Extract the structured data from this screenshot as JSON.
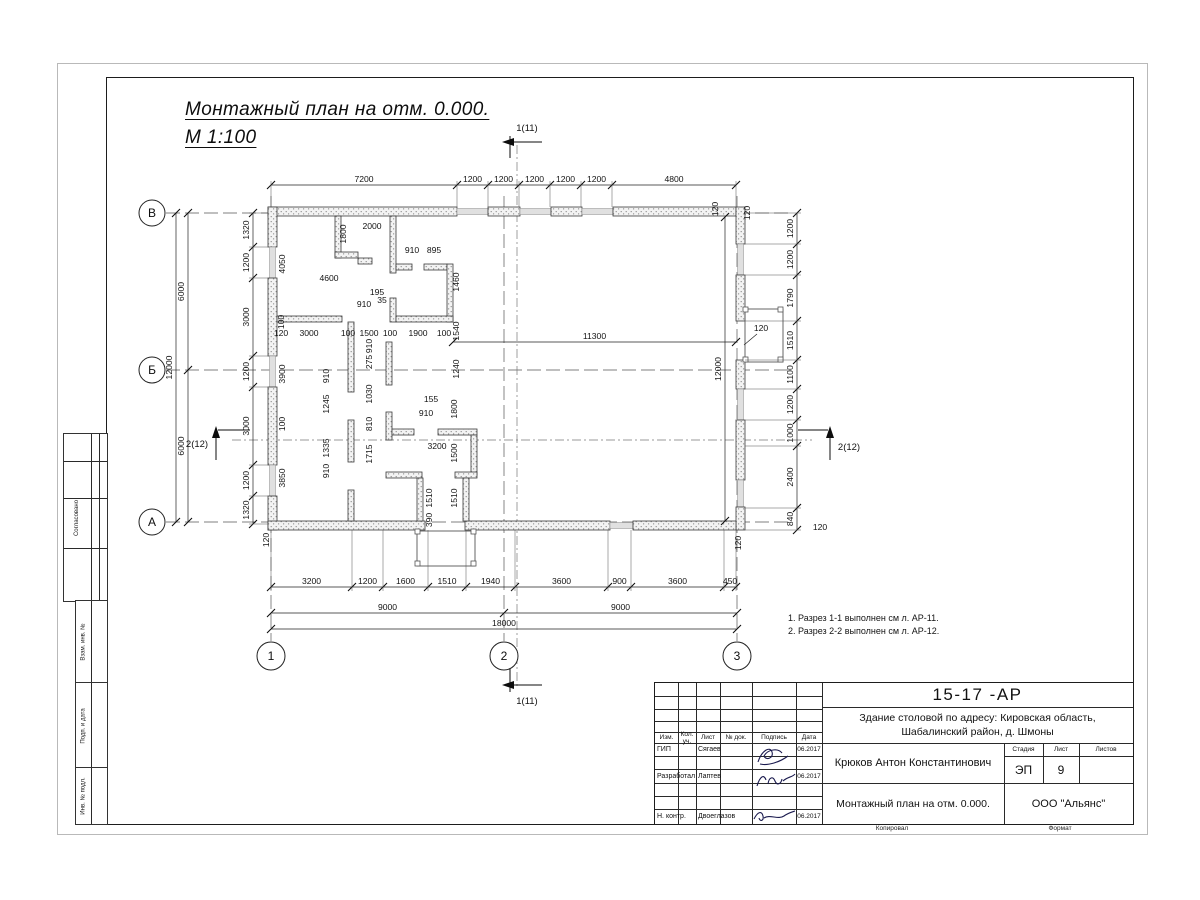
{
  "sheet": {
    "title_line1": "Монтажный план на отм. 0.000.",
    "title_line2": "М 1:100",
    "notes": [
      "1. Разрез 1-1 выполнен см л. АР-11.",
      "2. Разрез 2-2 выполнен см л. АР-12."
    ],
    "footer": {
      "copied": "Копировал",
      "format": "Формат"
    }
  },
  "side_panel": {
    "agree": "Согласовано",
    "vzam": "Взам. инв. №",
    "podp": "Подп. и дата",
    "inv": "Инв. № подл."
  },
  "title_block": {
    "doc_number": "15-17 -АР",
    "project_line1": "Здание столовой по адресу: Кировская область,",
    "project_line2": "Шабалинский район, д. Шмоны",
    "cols": {
      "izm": "Изм.",
      "kol": "Кол. уч.",
      "list": "Лист",
      "ndok": "№ док.",
      "podpis": "Подпись",
      "data": "Дата"
    },
    "rows": [
      {
        "role": "ГИП",
        "name": "Сягаев",
        "date": "06.2017"
      },
      {
        "role": "Разработал",
        "name": "Лаптев",
        "date": "06.2017"
      },
      {
        "role": "Н. контр.",
        "name": "Двоеглазов",
        "date": "06.2017"
      }
    ],
    "author": "Крюков Антон Константинович",
    "stage_label": "Стадия",
    "sheet_label": "Лист",
    "sheets_label": "Листов",
    "stage": "ЭП",
    "sheet_no": "9",
    "drawing_name": "Монтажный план на отм. 0.000.",
    "company": "ООО \"Альянс\""
  },
  "plan": {
    "axes": [
      {
        "label": "В",
        "x": 152,
        "y": 213,
        "r": 13
      },
      {
        "label": "Б",
        "x": 152,
        "y": 370,
        "r": 13
      },
      {
        "label": "А",
        "x": 152,
        "y": 522,
        "r": 13
      },
      {
        "label": "1",
        "x": 271,
        "y": 656,
        "r": 14
      },
      {
        "label": "2",
        "x": 504,
        "y": 656,
        "r": 14
      },
      {
        "label": "3",
        "x": 737,
        "y": 656,
        "r": 14
      }
    ],
    "chains": [
      {
        "dir": "h",
        "pos": 185,
        "ticks": [
          271,
          457,
          488,
          519,
          550,
          581,
          612,
          736
        ],
        "labels": [
          "7200",
          "1200",
          "1200",
          "1200",
          "1200",
          "1200",
          "4800"
        ],
        "ext": [
          181,
          207
        ]
      },
      {
        "dir": "v",
        "pos": 253,
        "ticks": [
          213,
          247,
          278,
          356,
          387,
          465,
          496,
          524
        ],
        "labels": [
          "1320",
          "1200",
          "3000",
          "1200",
          "3000",
          "1200",
          "1320"
        ],
        "ext": [
          249,
          268
        ]
      },
      {
        "dir": "v",
        "pos": 188,
        "ticks": [
          213,
          370,
          522
        ],
        "labels": [
          "6000",
          "6000"
        ],
        "ext": null
      },
      {
        "dir": "v",
        "pos": 176,
        "ticks": [
          213,
          522
        ],
        "labels": [
          "12000"
        ],
        "ext": null
      },
      {
        "dir": "v",
        "pos": 797,
        "ticks": [
          213,
          244,
          275,
          321,
          360,
          389,
          420,
          446,
          508,
          530
        ],
        "labels": [
          "1200",
          "1200",
          "1790",
          "1510",
          "1100",
          "1200",
          "1000",
          "2400",
          "840"
        ],
        "ext": [
          745,
          801
        ]
      },
      {
        "dir": "h",
        "pos": 587,
        "ticks": [
          271,
          352,
          383,
          428,
          466,
          515,
          608,
          631,
          724,
          736
        ],
        "labels": [
          "3200",
          "1200",
          "1600",
          "1510",
          "1940",
          "3600",
          "900",
          "3600",
          "450"
        ],
        "ext": [
          530,
          591
        ]
      },
      {
        "dir": "h",
        "pos": 613,
        "ticks": [
          271,
          504,
          737
        ],
        "labels": [
          "9000",
          "9000"
        ],
        "ext": null
      },
      {
        "dir": "h",
        "pos": 629,
        "ticks": [
          271,
          737
        ],
        "labels": [
          "18000"
        ],
        "ext": null
      },
      {
        "dir": "h",
        "pos": 342,
        "ticks": [
          453,
          736
        ],
        "labels": [
          "11300"
        ],
        "ext": null
      },
      {
        "dir": "v",
        "pos": 725,
        "ticks": [
          217,
          521
        ],
        "labels": [
          "12000"
        ],
        "ext": null
      }
    ],
    "labels": [
      {
        "t": "4050",
        "x": 285,
        "y": 264,
        "r": 1
      },
      {
        "t": "1800",
        "x": 346,
        "y": 234,
        "r": 1
      },
      {
        "t": "2000",
        "x": 372,
        "y": 229
      },
      {
        "t": "4600",
        "x": 329,
        "y": 281
      },
      {
        "t": "910",
        "x": 412,
        "y": 253
      },
      {
        "t": "895",
        "x": 434,
        "y": 253
      },
      {
        "t": "195",
        "x": 377,
        "y": 295
      },
      {
        "t": "910",
        "x": 364,
        "y": 307
      },
      {
        "t": "35",
        "x": 382,
        "y": 303
      },
      {
        "t": "1460",
        "x": 459,
        "y": 282,
        "r": 1
      },
      {
        "t": "1540",
        "x": 459,
        "y": 331,
        "r": 1
      },
      {
        "t": "100",
        "x": 284,
        "y": 322,
        "r": 1
      },
      {
        "t": "120",
        "x": 281,
        "y": 336
      },
      {
        "t": "3000",
        "x": 309,
        "y": 336
      },
      {
        "t": "100",
        "x": 348,
        "y": 336
      },
      {
        "t": "1500",
        "x": 369,
        "y": 336
      },
      {
        "t": "100",
        "x": 390,
        "y": 336
      },
      {
        "t": "1900",
        "x": 418,
        "y": 336
      },
      {
        "t": "100",
        "x": 444,
        "y": 336
      },
      {
        "t": "3900",
        "x": 285,
        "y": 374,
        "r": 1
      },
      {
        "t": "910",
        "x": 329,
        "y": 376,
        "r": 1
      },
      {
        "t": "1245",
        "x": 329,
        "y": 404,
        "r": 1
      },
      {
        "t": "100",
        "x": 285,
        "y": 424,
        "r": 1
      },
      {
        "t": "1335",
        "x": 329,
        "y": 448,
        "r": 1
      },
      {
        "t": "910",
        "x": 329,
        "y": 471,
        "r": 1
      },
      {
        "t": "3850",
        "x": 285,
        "y": 478,
        "r": 1
      },
      {
        "t": "910",
        "x": 372,
        "y": 346,
        "r": 1
      },
      {
        "t": "275",
        "x": 372,
        "y": 362,
        "r": 1
      },
      {
        "t": "1030",
        "x": 372,
        "y": 394,
        "r": 1
      },
      {
        "t": "810",
        "x": 372,
        "y": 424,
        "r": 1
      },
      {
        "t": "1715",
        "x": 372,
        "y": 454,
        "r": 1
      },
      {
        "t": "155",
        "x": 431,
        "y": 402
      },
      {
        "t": "910",
        "x": 426,
        "y": 416
      },
      {
        "t": "1240",
        "x": 459,
        "y": 369,
        "r": 1
      },
      {
        "t": "1800",
        "x": 457,
        "y": 409,
        "r": 1
      },
      {
        "t": "3200",
        "x": 437,
        "y": 449
      },
      {
        "t": "1500",
        "x": 457,
        "y": 453,
        "r": 1
      },
      {
        "t": "1510",
        "x": 432,
        "y": 498,
        "r": 1
      },
      {
        "t": "1510",
        "x": 457,
        "y": 498,
        "r": 1
      },
      {
        "t": "390",
        "x": 432,
        "y": 520,
        "r": 1
      },
      {
        "t": "120",
        "x": 269,
        "y": 540,
        "r": 1
      },
      {
        "t": "120",
        "x": 741,
        "y": 543,
        "r": 1
      },
      {
        "t": "120",
        "x": 718,
        "y": 209,
        "r": 1
      },
      {
        "t": "120",
        "x": 750,
        "y": 213,
        "r": 1
      },
      {
        "t": "120",
        "x": 761,
        "y": 331
      },
      {
        "t": "120",
        "x": 820,
        "y": 530
      }
    ],
    "section_markers": [
      {
        "label": "1(11)",
        "x": 527,
        "y": 131
      },
      {
        "label": "1(11)",
        "x": 527,
        "y": 704
      },
      {
        "label": "2(12)",
        "x": 197,
        "y": 447
      },
      {
        "label": "2(12)",
        "x": 849,
        "y": 450
      }
    ]
  }
}
